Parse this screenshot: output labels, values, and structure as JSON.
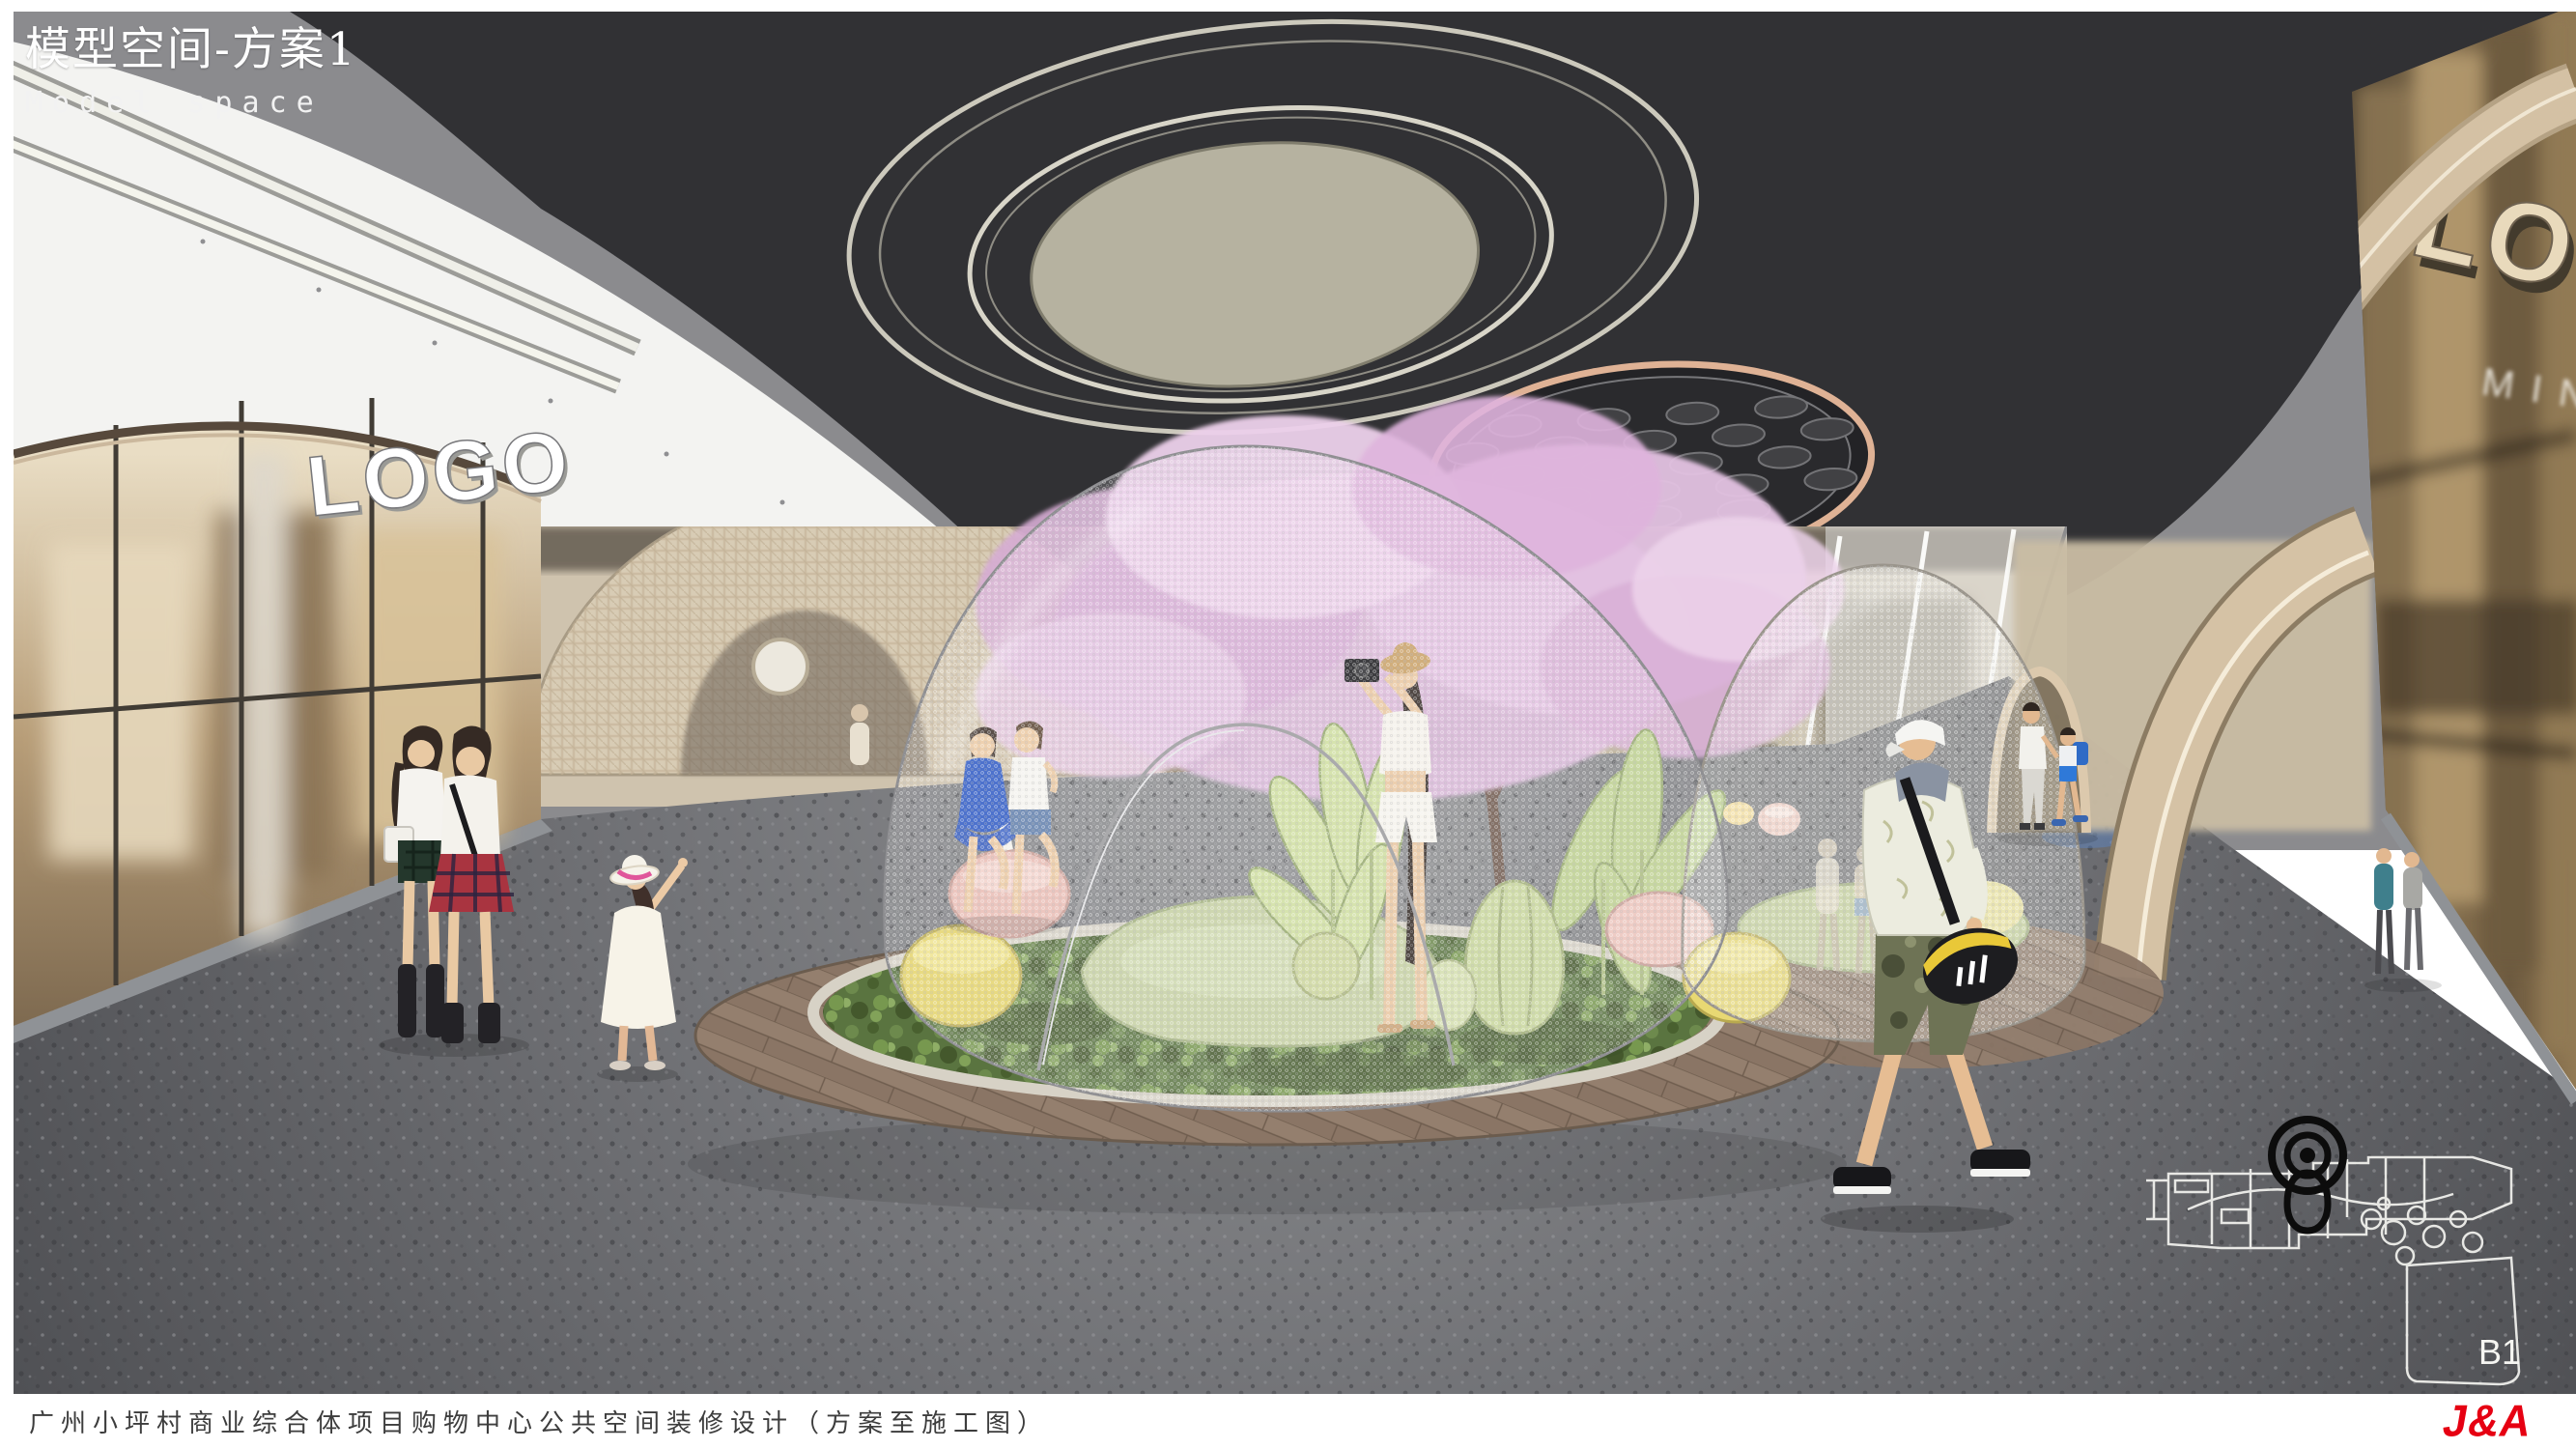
{
  "header": {
    "title": "模型空间-方案1",
    "subtitle": "Model space"
  },
  "scene": {
    "storefront_left": {
      "sign": "LOGO"
    },
    "storefront_right": {
      "sign": "LOGO",
      "poster_brand": "MINT"
    },
    "floor_plan": {
      "level_label": "B1"
    }
  },
  "footer": {
    "caption": "广州小坪村商业综合体项目购物中心公共空间装修设计（方案至施工图）",
    "brand_logo": "J&A"
  },
  "colors": {
    "brand_red": "#e60012",
    "ceiling_dark": "#313134",
    "ceiling_light_panel": "#b6b2a0",
    "copper_trim": "#dfb295",
    "blossom_pink": "#ddb9dc",
    "moss_green": "#5a7440",
    "grass_light": "#c6d1a2",
    "floor_gray": "#6a6b6e",
    "wood_deck": "#8a7565",
    "arch_beige": "#d5c2a5"
  }
}
